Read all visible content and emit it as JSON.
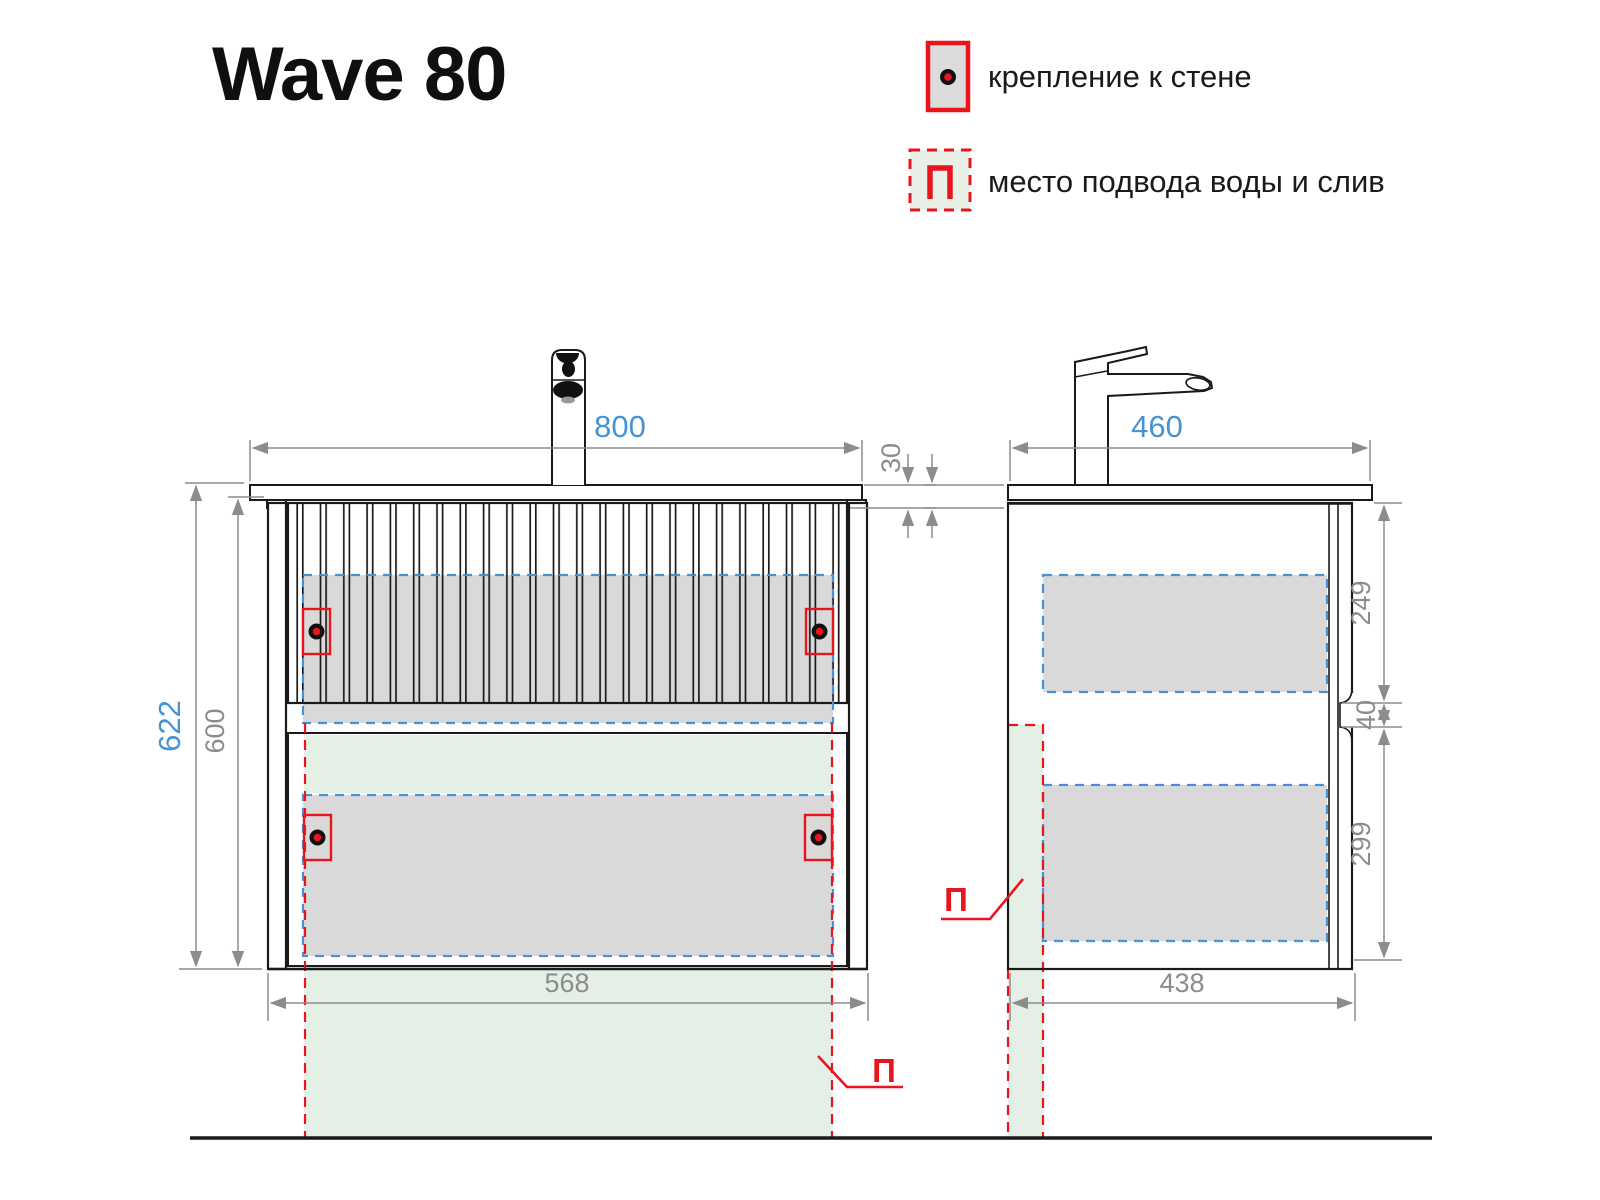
{
  "title": "Wave 80",
  "legend": {
    "wall_mount_label": "крепление к стене",
    "water_supply_label": "место подвода воды и слив",
    "water_symbol": "П"
  },
  "views": {
    "front": {
      "dims": {
        "top_width": "800",
        "countertop_thickness": "30",
        "total_height": "622",
        "body_height": "600",
        "bottom_width": "568"
      },
      "water_symbol": "П"
    },
    "side": {
      "dims": {
        "top_depth": "460",
        "upper_drawer_height": "249",
        "gap": "40",
        "lower_drawer_height": "299",
        "bottom_depth": "438"
      },
      "water_symbol": "П"
    }
  },
  "colors": {
    "accent_red": "#e8151d",
    "dim_blue": "#4793d2",
    "dash_blue": "#4a90d6",
    "dim_gray": "#8c8c8c",
    "line_black": "#1a1a1a",
    "panel_gray": "#d9d9d9",
    "zone_green": "#e4efe6"
  }
}
